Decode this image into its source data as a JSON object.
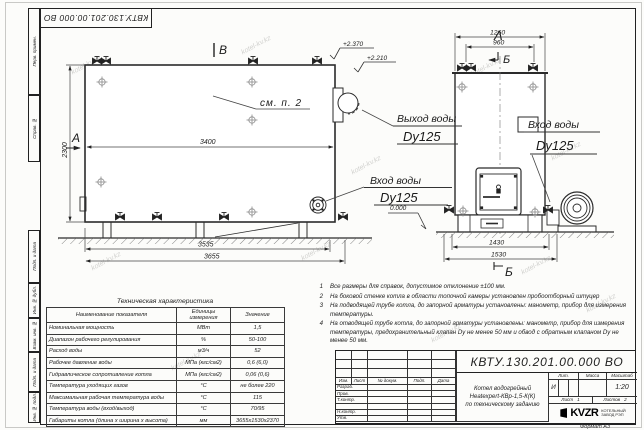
{
  "page": {
    "doc_number": "КВТУ.130.201.00.000  ВО",
    "format_label": "Формат  А3",
    "watermark": "kotel-kv.kz"
  },
  "side_strip": {
    "items": [
      "Перв. примен.",
      "Справ. №",
      "Подп. и дата",
      "Инв. № дубл.",
      "Взам. инв. №",
      "Подп. и дата",
      "Инв. № подл."
    ]
  },
  "drawing": {
    "side_view": {
      "section_label_top": "В",
      "section_label_left": "А",
      "see_note": "см. п. 2",
      "dim_inner_width": "3400",
      "dim_height": "2300",
      "dim_base": "3535",
      "dim_overall": "3655",
      "level_top": "+2.370",
      "level_ledge": "+2.210",
      "inlet_title": "Вход воды",
      "inlet_size": "Dy125"
    },
    "front_view": {
      "view_label": "А",
      "section_label": "Б",
      "dim_top_overall": "1260",
      "dim_top_inner": "960",
      "dim_base": "1430",
      "dim_overall": "1530",
      "outlet_title": "Выход воды",
      "outlet_size": "Dy125",
      "inlet_title": "Вход воды",
      "inlet_size": "Dy125",
      "level_zero": "0.000"
    }
  },
  "notes": {
    "items": [
      {
        "n": "1",
        "text": "Все размеры для справок, допустимое отклонение  ±100 мм."
      },
      {
        "n": "2",
        "text": "На боковой стенке котла в области топочной камеры установлен пробоотборный штуцер"
      },
      {
        "n": "3",
        "text": "На  подводящей трубе котла, до запорной арматуры установлены: манометр, прибор для измерения температуры."
      },
      {
        "n": "4",
        "text": "На отводящей трубе котла, до запорной арматуры установлены: манометр, прибор для измерения температуры, предохранительный клапан  Dy не менее  50 мм и обвод с обратным клапаном  Dy не менее  50 мм."
      }
    ]
  },
  "tech_table": {
    "title": "Техническая характеристика",
    "headers": [
      "Наименование показателя",
      "Единицы измерения",
      "Значение"
    ],
    "rows": [
      [
        "Номинальная мощность",
        "МВт",
        "1,5"
      ],
      [
        "Диапазон рабочего регулирования",
        "%",
        "50-100"
      ],
      [
        "Расход воды",
        "м3/ч",
        "52"
      ],
      [
        "Рабочее давление воды",
        "МПа (кгс/см2)",
        "0,6 (6,0)"
      ],
      [
        "Гидравлическое сопротивление котла",
        "МПа (кгс/см2)",
        "0,06 (0,6)"
      ],
      [
        "Температура уходящих газов",
        "°С",
        "не более 220"
      ],
      [
        "Максимальная рабочая температура воды",
        "°С",
        "115"
      ],
      [
        "Температура воды (вход/выход)",
        "°С",
        "70/95"
      ],
      [
        "Габариты котла (длина х ширина х высота)",
        "мм",
        "3655х1530х2370"
      ]
    ]
  },
  "title_block": {
    "doc_number": "КВТУ.130.201.00.000  ВО",
    "header_cols": [
      "Изм.",
      "Лист",
      "№ докум.",
      "Подп.",
      "Дата"
    ],
    "row_labels": [
      "Разраб.",
      "Пров.",
      "Т.контр.",
      "",
      "Н.контр.",
      "Утв."
    ],
    "name_lines": [
      "Котел водогрейный",
      "Heatexpert-КВр-1,5-К(К)",
      "по техническому заданию"
    ],
    "lit_label": "Лит.",
    "mass_label": "Масса",
    "scale_label": "Масштаб",
    "lit_value": "И",
    "scale_value": "1:20",
    "sheet_label": "Лист",
    "sheet_value": "1",
    "sheets_label": "Листов",
    "sheets_value": "2",
    "company_logo": "KVZR",
    "company_line1": "КОТЕЛЬНЫЙ",
    "company_line2": "ЗАВОД РЭП"
  }
}
